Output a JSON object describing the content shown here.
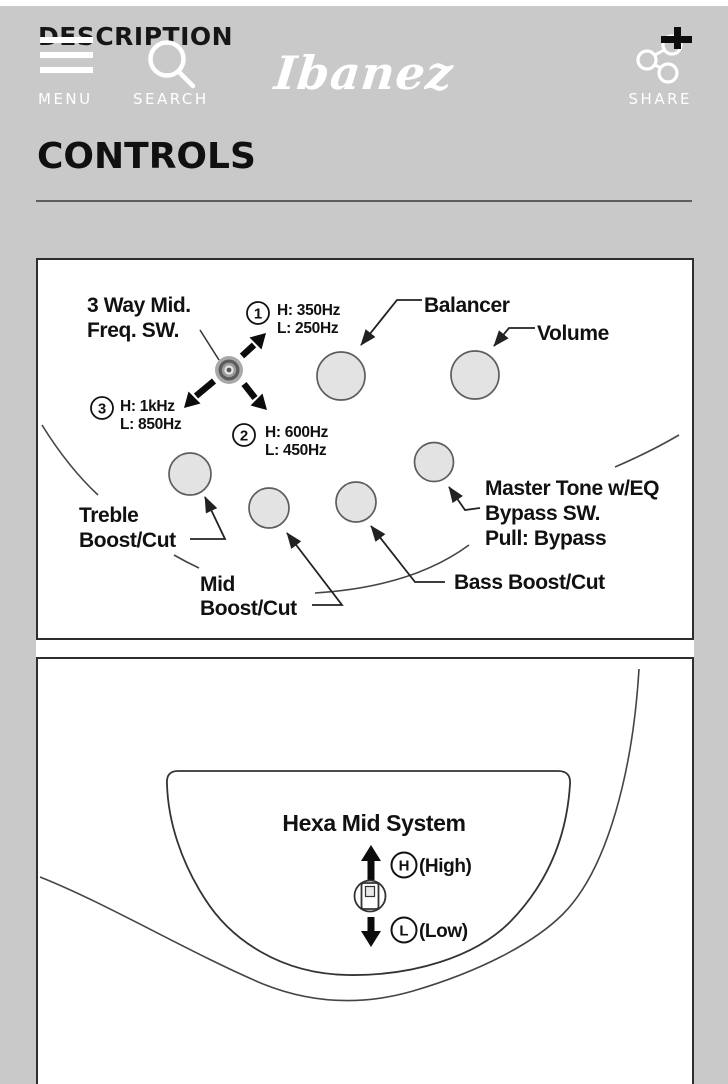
{
  "header": {
    "overlay_title": "DESCRIPTION",
    "menu_label": "MENU",
    "search_label": "SEARCH",
    "share_label": "SHARE",
    "logo_text": "Ibanez"
  },
  "section": {
    "title": "CONTROLS"
  },
  "colors": {
    "page_bg": "#c9c9c9",
    "panel_bg": "#ffffff",
    "ink": "#111111",
    "knob_fill": "#e3e3e3"
  },
  "diagram1": {
    "freq_switch_label_1": "3 Way Mid.",
    "freq_switch_label_2": "Freq. SW.",
    "pos1": {
      "num": "1",
      "high": "H: 350Hz",
      "low": "L: 250Hz"
    },
    "pos2": {
      "num": "2",
      "high": "H: 600Hz",
      "low": "L: 450Hz"
    },
    "pos3": {
      "num": "3",
      "high": "H: 1kHz",
      "low": "L: 850Hz"
    },
    "balancer": "Balancer",
    "volume": "Volume",
    "treble_1": "Treble",
    "treble_2": "Boost/Cut",
    "mid_1": "Mid",
    "mid_2": "Boost/Cut",
    "bass": "Bass Boost/Cut",
    "master_1": "Master Tone w/EQ",
    "master_2": "Bypass SW.",
    "master_3": "Pull: Bypass"
  },
  "diagram2": {
    "title": "Hexa Mid System",
    "high_letter": "H",
    "high_label": "(High)",
    "low_letter": "L",
    "low_label": "(Low)"
  }
}
